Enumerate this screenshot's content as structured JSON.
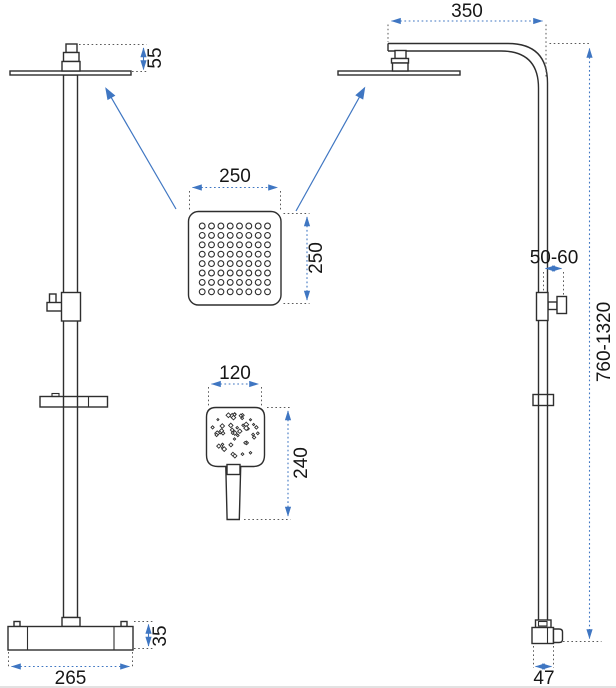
{
  "drawing": {
    "kind": "shower-set-technical-drawing",
    "views": {
      "left_column": {
        "dimensions": {
          "head_connector_height": "55",
          "mixer_height": "35",
          "mixer_width": "265"
        }
      },
      "right_column": {
        "dimensions": {
          "arm_reach": "350",
          "holder_offset": "50-60",
          "column_height_range": "760-1320",
          "outlet_width": "47"
        }
      },
      "overhead_shower_detail": {
        "dimensions": {
          "width": "250",
          "height": "250"
        }
      },
      "hand_shower_detail": {
        "dimensions": {
          "width": "120",
          "height": "240"
        }
      }
    }
  },
  "colors": {
    "dimension_blue": "#3f76c2",
    "line_dark": "#2e2e2e",
    "extension_gray": "#5a5a5a",
    "page_edge": "#d9d9d9",
    "background": "#ffffff"
  },
  "icons": {
    "pointer_arrow": "arrow-icon",
    "dimension_arrow": "arrowhead-icon"
  }
}
